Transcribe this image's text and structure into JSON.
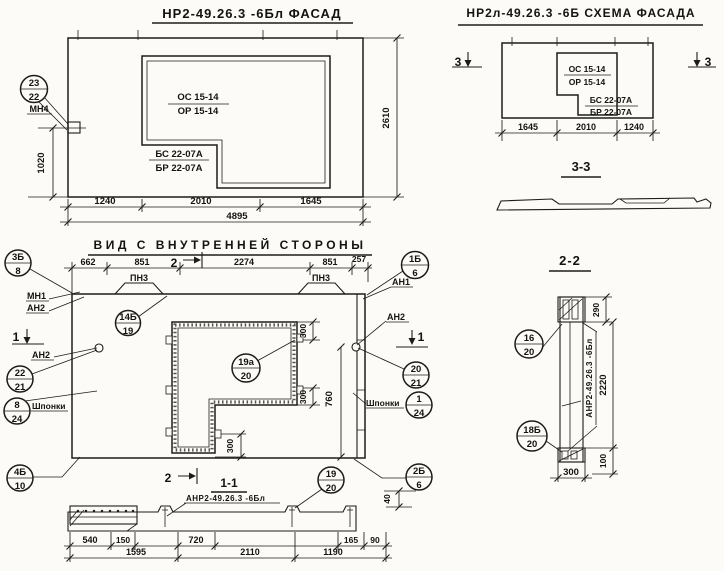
{
  "colors": {
    "ink": "#1d1c1a",
    "paper": "#fcfbf7"
  },
  "facade": {
    "title": "НР2-49.26.3 -6Бл  ФАСАД",
    "window_mark_line1": "ОС 15-14",
    "window_mark_line2": "ОР 15-14",
    "sill_mark_line1": "БС 22-07А",
    "sill_mark_line2": "БР 22-07А",
    "callout_anchor": {
      "pos": "23",
      "sheet": "22",
      "label": "МН4"
    },
    "dim_height_window": "1020",
    "dim_height_panel": "2610",
    "dims_width": [
      "1240",
      "2010",
      "1645"
    ],
    "dim_width_total": "4895"
  },
  "schema": {
    "title": "НР2л-49.26.3 -6Б  СХЕМА ФАСАДА",
    "section_mark": "3",
    "window_mark_line1": "ОС 15-14",
    "window_mark_line2": "ОР 15-14",
    "sill_mark_line1": "БС 22-07А",
    "sill_mark_line2": "БР 22-07А",
    "dims_width": [
      "1645",
      "2010",
      "1240"
    ]
  },
  "section33": {
    "title": "3-3"
  },
  "inner": {
    "title": "ВИД С ВНУТРЕННЕЙ СТОРОНЫ",
    "dims_top": [
      "662",
      "851",
      "2274",
      "851",
      "257"
    ],
    "cut2_mark": "2",
    "cut1_mark": "1",
    "loop_left": "ПН3",
    "loop_right": "ПН3",
    "label_mn1": "МН1",
    "label_an2_left_top": "АН2",
    "label_an2_left": "АН2",
    "label_an1": "АН1",
    "label_an2_right": "АН2",
    "label_keys_left": "Шпонки",
    "label_keys_right": "Шпонки",
    "dim_300_top": "300",
    "dim_300_mid": "300",
    "dim_300_bottom": "300",
    "dim_760": "760",
    "dim_40": "40",
    "callouts": {
      "left_top": {
        "pos": "3Б",
        "sheet": "8"
      },
      "left_mid": {
        "pos": "22",
        "sheet": "21"
      },
      "left_keys": {
        "pos": "8",
        "sheet": "24"
      },
      "left_bottom": {
        "pos": "4Б",
        "sheet": "10"
      },
      "right_top": {
        "pos": "1Б",
        "sheet": "6"
      },
      "right_mid": {
        "pos": "20",
        "sheet": "21"
      },
      "right_keys": {
        "pos": "1",
        "sheet": "24"
      },
      "right_bottom": {
        "pos": "2Б",
        "sheet": "6"
      },
      "cut_bottom": {
        "pos": "19",
        "sheet": "20"
      },
      "inner_top": {
        "pos": "14Б",
        "sheet": "19"
      },
      "opening": {
        "pos": "19а",
        "sheet": "20"
      }
    }
  },
  "section11": {
    "title": "1-1",
    "cut2_mark": "2",
    "item_label": "АНР2-49.26.3 -6Бл",
    "dims_row1": [
      "540",
      "150",
      "720",
      "165",
      "90"
    ],
    "dims_row2": [
      "1595",
      "2110",
      "1190"
    ]
  },
  "section22": {
    "title": "2-2",
    "item_label": "АНР2-49.26.3 -6Бл",
    "dim_290": "290",
    "dim_2220": "2220",
    "dim_300": "300",
    "dim_100": "100",
    "callouts": {
      "top": {
        "pos": "16",
        "sheet": "20"
      },
      "bottom": {
        "pos": "18Б",
        "sheet": "20"
      }
    }
  }
}
